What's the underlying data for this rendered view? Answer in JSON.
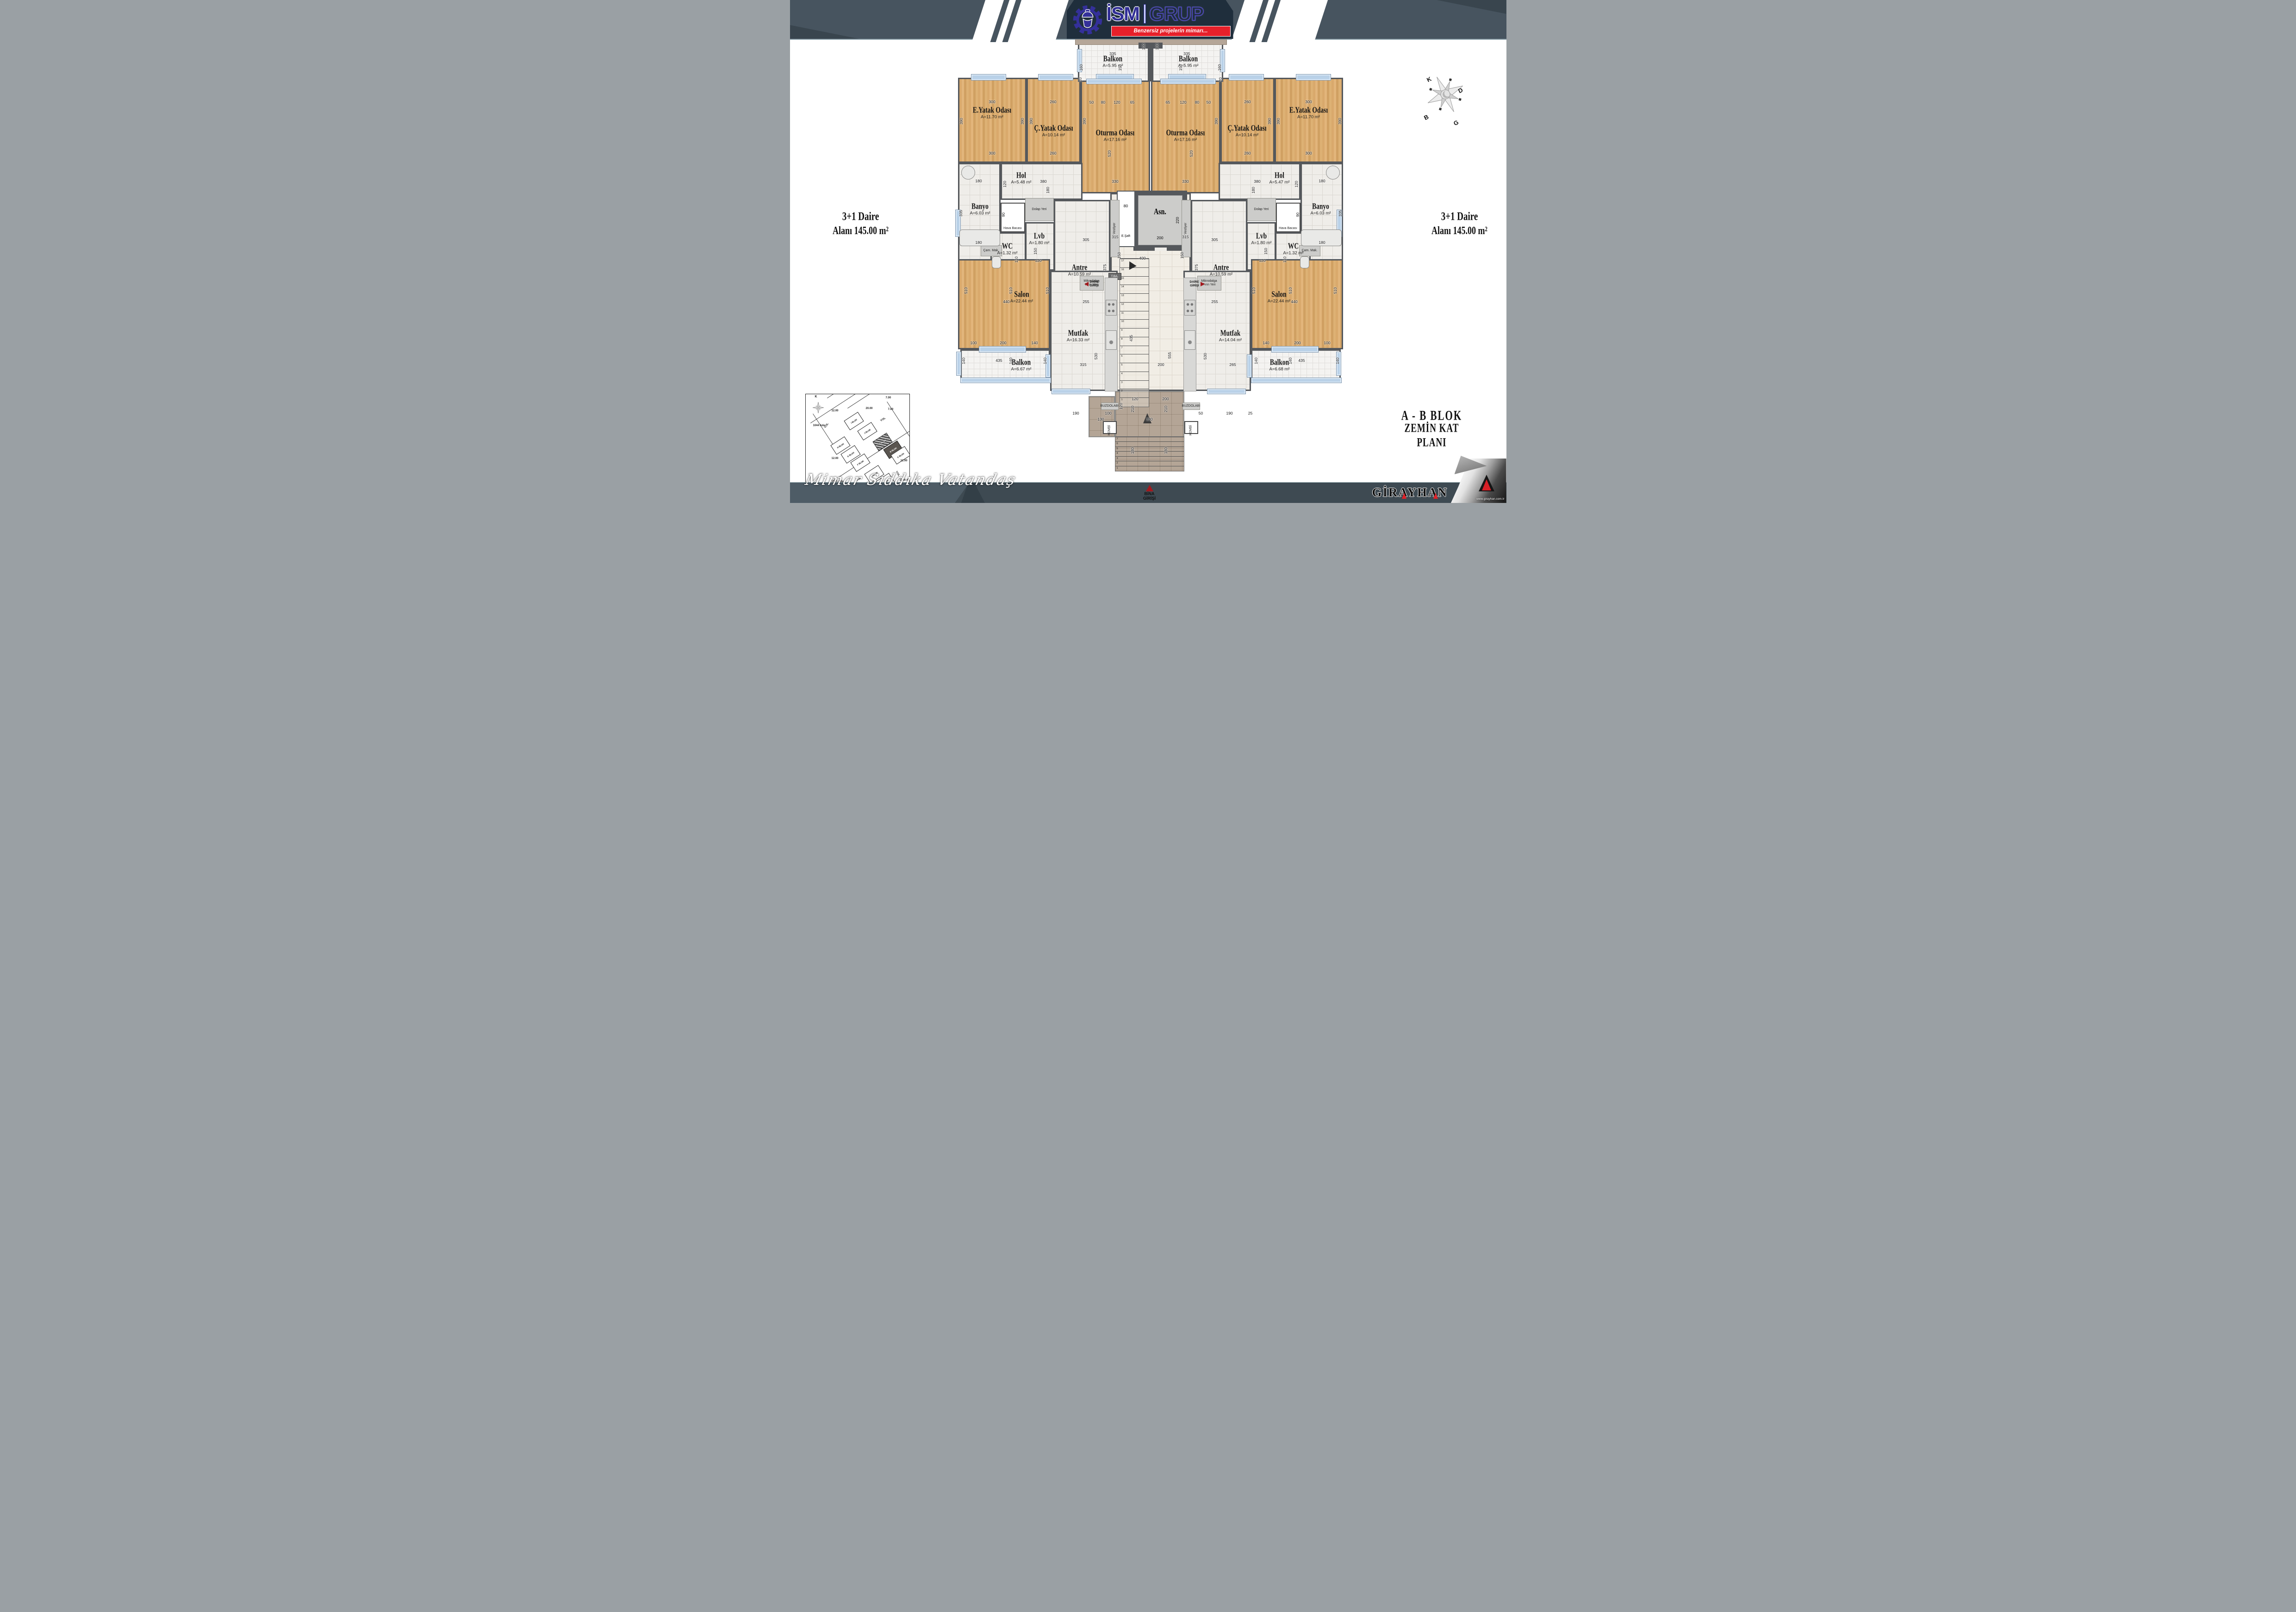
{
  "header": {
    "brand_left": "İSM",
    "brand_right": "GRUP",
    "tagline": "Benzersiz projelerin mimarı...",
    "logo_icon": "gear-helmet-icon"
  },
  "side_labels": {
    "left": {
      "line1": "3+1  Daire",
      "line2": "Alanı  145.00 m²"
    },
    "right": {
      "line1": "3+1  Daire",
      "line2": "Alanı  145.00 m²"
    }
  },
  "title_block": {
    "line1": "A - B   BLOK",
    "line2": "ZEMİN KAT PLANI"
  },
  "signature": "Mimar Sıddıka Vatandaş",
  "footer": {
    "girayhan": "GİRAYHAN",
    "url": "www.girayhan.com.tr"
  },
  "compass": {
    "n": "K",
    "e": "D",
    "w": "B",
    "s": "G"
  },
  "colors": {
    "accent_red": "#e6202a",
    "logo_blue": "#312e96",
    "band_slate": "#47545f",
    "panel_navy": "#1f2e3c",
    "wall_gray": "#55585c",
    "wood": "#d9a96c",
    "window_blue": "#b9d1e8",
    "entry_red": "#a3191e"
  },
  "plan": {
    "entrance": {
      "line1": "BİNA",
      "line2": "GİRİŞİ"
    },
    "daire_girisi": {
      "line1": "DAİRE",
      "line2": "GİRİŞİ"
    },
    "elevator": {
      "label": "Asn.",
      "w_dim": "200",
      "h_dim": "220"
    },
    "shaft": {
      "label": "E.Şaft",
      "w_dim": "80",
      "h_dim": "230"
    },
    "stairs": {
      "main": 17,
      "entry": 7
    },
    "rooms": [
      [
        "",
        "",
        692,
        417,
        174,
        428,
        "tile2",
        0,
        0
      ],
      [
        "E.Yatak Odası",
        "A=11.70 m²",
        363,
        168,
        148,
        184,
        "wood",
        437,
        238
      ],
      [
        "Ç.Yatak Odası",
        "A=10.14 m²",
        511,
        168,
        117,
        184,
        "wood",
        570,
        277
      ],
      [
        "Oturma Odası",
        "A=17.16 m²",
        628,
        168,
        150,
        250,
        "wood",
        703,
        287
      ],
      [
        "Hol",
        "A=5.48 m²",
        455,
        352,
        177,
        80,
        "tile",
        500,
        379
      ],
      [
        "Banyo",
        "A=6.03 m²",
        363,
        352,
        92,
        233,
        "tile",
        411,
        446
      ],
      [
        "WC",
        "A=1.32 m²",
        433,
        502,
        77,
        83,
        "tile",
        470,
        532
      ],
      [
        "Lvb",
        "A=1.80 m²",
        508,
        480,
        64,
        105,
        "tile",
        539,
        510
      ],
      [
        "Antre",
        "A=10.59 m²",
        570,
        432,
        122,
        200,
        "tile",
        626,
        578
      ],
      [
        "Salon",
        "A=22.44 m²",
        363,
        560,
        199,
        195,
        "wood",
        501,
        636
      ],
      [
        "Mutfak",
        "A=16.33 m²",
        562,
        585,
        146,
        260,
        "tile",
        623,
        720
      ],
      [
        "Balkon",
        "A=6.67 m²",
        368,
        755,
        194,
        70,
        "bal",
        500,
        783
      ],
      [
        "Balkon",
        "A=5.95 m²",
        622,
        93,
        154,
        84,
        "bal",
        698,
        127
      ],
      [
        "E.Yatak Odası",
        "A=11.70 m²",
        1047,
        168,
        148,
        184,
        "wood",
        1121,
        238
      ],
      [
        "Ç.Yatak Odası",
        "A=10.14 m²",
        930,
        168,
        117,
        184,
        "wood",
        988,
        277
      ],
      [
        "Oturma Odası",
        "A=17.16 m²",
        780,
        168,
        150,
        250,
        "wood",
        855,
        287
      ],
      [
        "Hol",
        "A=5.47 m²",
        926,
        352,
        177,
        80,
        "tile",
        1058,
        379
      ],
      [
        "Banyo",
        "A=6.03 m²",
        1103,
        352,
        92,
        233,
        "tile",
        1147,
        446
      ],
      [
        "WC",
        "A=1.32 m²",
        1048,
        502,
        77,
        83,
        "tile",
        1088,
        532
      ],
      [
        "Lvb",
        "A=1.80 m²",
        986,
        480,
        64,
        105,
        "tile",
        1019,
        510
      ],
      [
        "Antre",
        "A=10.59 m²",
        866,
        432,
        122,
        200,
        "tile",
        932,
        578
      ],
      [
        "Salon",
        "A=22.44 m²",
        996,
        560,
        199,
        195,
        "wood",
        1057,
        636
      ],
      [
        "Mutfak",
        "A=14.04 m²",
        850,
        585,
        146,
        260,
        "tile",
        952,
        720
      ],
      [
        "Balkon",
        "A=6.68 m²",
        996,
        755,
        194,
        70,
        "bal",
        1058,
        783
      ],
      [
        "Balkon",
        "A=5.95 m²",
        782,
        93,
        154,
        84,
        "bal",
        861,
        127
      ]
    ],
    "windows": [
      [
        391,
        160,
        74,
        12
      ],
      [
        536,
        160,
        74,
        12
      ],
      [
        661,
        160,
        80,
        12
      ],
      [
        817,
        160,
        80,
        12
      ],
      [
        948,
        160,
        74,
        12
      ],
      [
        1093,
        160,
        74,
        12
      ],
      [
        640,
        170,
        118,
        10
      ],
      [
        800,
        170,
        118,
        10
      ],
      [
        620,
        106,
        9,
        48
      ],
      [
        929,
        106,
        9,
        48
      ],
      [
        357,
        453,
        10,
        57
      ],
      [
        1181,
        453,
        10,
        57
      ],
      [
        359,
        760,
        9,
        50
      ],
      [
        1180,
        760,
        9,
        50
      ],
      [
        408,
        748,
        100,
        12
      ],
      [
        1040,
        748,
        100,
        12
      ],
      [
        368,
        816,
        194,
        10
      ],
      [
        996,
        816,
        194,
        10
      ],
      [
        565,
        840,
        82,
        10
      ],
      [
        901,
        840,
        82,
        10
      ],
      [
        552,
        766,
        9,
        48
      ],
      [
        987,
        766,
        9,
        48
      ]
    ],
    "boxes": [
      [
        "Dolap Yeri",
        508,
        428,
        62,
        50,
        "bg"
      ],
      [
        "Dolap Yeri",
        988,
        428,
        62,
        50,
        "bg"
      ],
      [
        "Hava Bacası",
        455,
        438,
        53,
        64,
        "bw"
      ],
      [
        "Hava Bacası",
        1050,
        438,
        53,
        64,
        "bw"
      ],
      [
        "Vestiyer",
        692,
        432,
        20,
        124,
        "bg v"
      ],
      [
        "Vestiyer",
        846,
        432,
        20,
        124,
        "bg v"
      ],
      [
        "Çam. Mak.",
        412,
        530,
        46,
        24,
        "bg"
      ],
      [
        "Çam. Mak.",
        1100,
        530,
        46,
        24,
        "bg"
      ],
      [
        "Mikrodalga Fırın Yeri",
        626,
        596,
        52,
        32,
        "bg"
      ],
      [
        "Mikrodalga Fırın Yeri",
        880,
        596,
        52,
        32,
        "bg"
      ],
      [
        "BUZDOLABI",
        672,
        870,
        38,
        16,
        "bg"
      ],
      [
        "BUZDOLABI",
        848,
        870,
        38,
        16,
        "bg"
      ],
      [
        "KOMBİ",
        676,
        910,
        30,
        28,
        "bw v"
      ],
      [
        "KOMBİ",
        852,
        910,
        30,
        28,
        "bw v"
      ],
      [
        "T.BA.",
        688,
        590,
        28,
        15,
        "bd"
      ],
      [
        "",
        680,
        600,
        28,
        246,
        "bc"
      ],
      [
        "",
        850,
        600,
        28,
        246,
        "bc"
      ],
      [
        "",
        682,
        648,
        24,
        34,
        "stove"
      ],
      [
        "",
        852,
        648,
        24,
        34,
        "stove"
      ],
      [
        "",
        682,
        714,
        24,
        42,
        "sink"
      ],
      [
        "",
        852,
        714,
        24,
        42,
        "sink"
      ],
      [
        "",
        366,
        496,
        88,
        36,
        "bf"
      ],
      [
        "",
        1104,
        496,
        88,
        36,
        "bf"
      ],
      [
        "",
        370,
        358,
        30,
        30,
        "br"
      ],
      [
        "",
        1158,
        358,
        30,
        30,
        "br"
      ],
      [
        "",
        436,
        554,
        20,
        26,
        "bf"
      ],
      [
        "",
        1102,
        554,
        20,
        26,
        "bf"
      ]
    ],
    "dims": [
      [
        "335",
        698,
        116,
        0
      ],
      [
        "335",
        858,
        116,
        0
      ],
      [
        "160",
        629,
        146,
        1
      ],
      [
        "160",
        928,
        146,
        1
      ],
      [
        "150",
        713,
        146,
        1
      ],
      [
        "150",
        844,
        146,
        1
      ],
      [
        "100",
        764,
        101,
        1
      ],
      [
        "100",
        793,
        101,
        1
      ],
      [
        "300",
        437,
        220,
        0
      ],
      [
        "260",
        569,
        220,
        0
      ],
      [
        "50",
        652,
        221,
        0
      ],
      [
        "80",
        677,
        221,
        0
      ],
      [
        "120",
        707,
        221,
        0
      ],
      [
        "65",
        740,
        221,
        0
      ],
      [
        "65",
        817,
        221,
        0
      ],
      [
        "120",
        850,
        221,
        0
      ],
      [
        "80",
        880,
        221,
        0
      ],
      [
        "50",
        905,
        221,
        0
      ],
      [
        "260",
        989,
        220,
        0
      ],
      [
        "300",
        1121,
        220,
        0
      ],
      [
        "390",
        370,
        262,
        1
      ],
      [
        "390",
        502,
        262,
        1
      ],
      [
        "390",
        521,
        262,
        1
      ],
      [
        "390",
        636,
        262,
        1
      ],
      [
        "390",
        921,
        262,
        1
      ],
      [
        "390",
        1036,
        262,
        1
      ],
      [
        "390",
        1055,
        262,
        1
      ],
      [
        "390",
        1188,
        262,
        1
      ],
      [
        "520",
        690,
        332,
        1
      ],
      [
        "520",
        867,
        332,
        1
      ],
      [
        "300",
        437,
        331,
        0
      ],
      [
        "260",
        569,
        331,
        0
      ],
      [
        "260",
        989,
        331,
        0
      ],
      [
        "300",
        1121,
        331,
        0
      ],
      [
        "330",
        703,
        392,
        0
      ],
      [
        "330",
        855,
        392,
        0
      ],
      [
        "315",
        703,
        512,
        0
      ],
      [
        "315",
        855,
        512,
        0
      ],
      [
        "180",
        408,
        391,
        0
      ],
      [
        "120",
        464,
        398,
        1
      ],
      [
        "380",
        548,
        392,
        0
      ],
      [
        "180",
        557,
        411,
        1
      ],
      [
        "180",
        1150,
        391,
        0
      ],
      [
        "120",
        1094,
        398,
        1
      ],
      [
        "380",
        1010,
        392,
        0
      ],
      [
        "180",
        1001,
        411,
        1
      ],
      [
        "335",
        369,
        461,
        1
      ],
      [
        "90",
        461,
        464,
        1
      ],
      [
        "335",
        1189,
        461,
        1
      ],
      [
        "90",
        1097,
        464,
        1
      ],
      [
        "180",
        408,
        524,
        0
      ],
      [
        "180",
        1150,
        524,
        0
      ],
      [
        "150",
        530,
        543,
        1
      ],
      [
        "120",
        537,
        563,
        0
      ],
      [
        "110",
        489,
        561,
        1
      ],
      [
        "150",
        1028,
        543,
        1
      ],
      [
        "120",
        1021,
        563,
        0
      ],
      [
        "110",
        1069,
        561,
        1
      ],
      [
        "305",
        640,
        518,
        0
      ],
      [
        "375",
        680,
        578,
        1
      ],
      [
        "255",
        640,
        652,
        0
      ],
      [
        "440",
        468,
        652,
        0
      ],
      [
        "305",
        918,
        518,
        0
      ],
      [
        "375",
        878,
        578,
        1
      ],
      [
        "255",
        918,
        652,
        0
      ],
      [
        "440",
        1090,
        652,
        0
      ],
      [
        "400",
        762,
        558,
        0
      ],
      [
        "150",
        711,
        552,
        1
      ],
      [
        "150",
        847,
        552,
        1
      ],
      [
        "510",
        380,
        628,
        1
      ],
      [
        "510",
        477,
        628,
        1
      ],
      [
        "510",
        556,
        628,
        1
      ],
      [
        "510",
        1002,
        628,
        1
      ],
      [
        "510",
        1081,
        628,
        1
      ],
      [
        "510",
        1178,
        628,
        1
      ],
      [
        "100",
        397,
        741,
        0
      ],
      [
        "200",
        461,
        741,
        0
      ],
      [
        "140",
        529,
        741,
        0
      ],
      [
        "140",
        1029,
        741,
        0
      ],
      [
        "200",
        1097,
        741,
        0
      ],
      [
        "100",
        1161,
        741,
        0
      ],
      [
        "435",
        452,
        779,
        0
      ],
      [
        "140",
        375,
        780,
        1
      ],
      [
        "140",
        477,
        780,
        1
      ],
      [
        "140",
        551,
        780,
        1
      ],
      [
        "435",
        1106,
        779,
        0
      ],
      [
        "140",
        1007,
        780,
        1
      ],
      [
        "140",
        1081,
        780,
        1
      ],
      [
        "140",
        1183,
        780,
        1
      ],
      [
        "315",
        634,
        788,
        0
      ],
      [
        "530",
        661,
        770,
        1
      ],
      [
        "265",
        957,
        788,
        0
      ],
      [
        "530",
        897,
        770,
        1
      ],
      [
        "190",
        618,
        893,
        0
      ],
      [
        "100",
        688,
        893,
        0
      ],
      [
        "50",
        888,
        893,
        0
      ],
      [
        "190",
        950,
        893,
        0
      ],
      [
        "25",
        995,
        893,
        0
      ],
      [
        "435",
        737,
        731,
        1
      ],
      [
        "555",
        820,
        768,
        1
      ],
      [
        "200",
        802,
        788,
        0
      ],
      [
        "120",
        746,
        862,
        0
      ],
      [
        "200",
        812,
        862,
        0
      ],
      [
        "120",
        715,
        878,
        1
      ],
      [
        "130",
        672,
        906,
        0
      ],
      [
        "330",
        777,
        906,
        0
      ],
      [
        "210",
        740,
        884,
        1
      ],
      [
        "210",
        812,
        884,
        1
      ],
      [
        "180",
        740,
        974,
        1
      ],
      [
        "180",
        812,
        974,
        1
      ],
      [
        "20",
        627,
        172,
        1
      ],
      [
        "20",
        930,
        172,
        1
      ]
    ]
  },
  "site_plan": {
    "compass_letter": "K",
    "blocks": [
      [
        "I BLOK",
        86,
        46,
        ""
      ],
      [
        "J BLOK",
        115,
        68,
        ""
      ],
      [
        "A BLOK",
        148,
        91,
        "hatch"
      ],
      [
        "B BLOK",
        171,
        108,
        "dark"
      ],
      [
        "C BLOK",
        187,
        120,
        ""
      ],
      [
        "H BLOK",
        57,
        99,
        ""
      ],
      [
        "G BLOK",
        79,
        118,
        ""
      ],
      [
        "F BLOK",
        100,
        136,
        ""
      ],
      [
        "E BLOK",
        130,
        161,
        ""
      ],
      [
        "D BLOK",
        153,
        178,
        ""
      ]
    ],
    "labels": [
      [
        "YOL",
        39,
        65,
        -57
      ],
      [
        "YOL",
        161,
        52,
        -33
      ],
      [
        "YOL",
        109,
        181,
        -33
      ],
      [
        "YOL",
        192,
        169,
        57
      ],
      [
        "12.00",
        56,
        33,
        0
      ],
      [
        "20.00",
        130,
        28,
        0
      ],
      [
        "7.00",
        173,
        5,
        0
      ],
      [
        "7.00",
        178,
        30,
        0
      ],
      [
        "12.00",
        56,
        136,
        0
      ],
      [
        "12.00",
        205,
        141,
        0
      ],
      [
        "1044 Ada",
        16,
        65,
        0
      ],
      [
        "1501 Ada",
        56,
        186,
        0
      ],
      [
        "1386 Ada",
        203,
        183,
        0
      ]
    ],
    "lines": [
      [
        10,
        62,
        150,
        -33
      ],
      [
        60,
        186,
        225,
        -33
      ],
      [
        90,
        30,
        160,
        -33
      ],
      [
        176,
        16,
        130,
        57
      ],
      [
        16,
        42,
        95,
        57
      ],
      [
        46,
        8,
        150,
        -33
      ]
    ]
  }
}
